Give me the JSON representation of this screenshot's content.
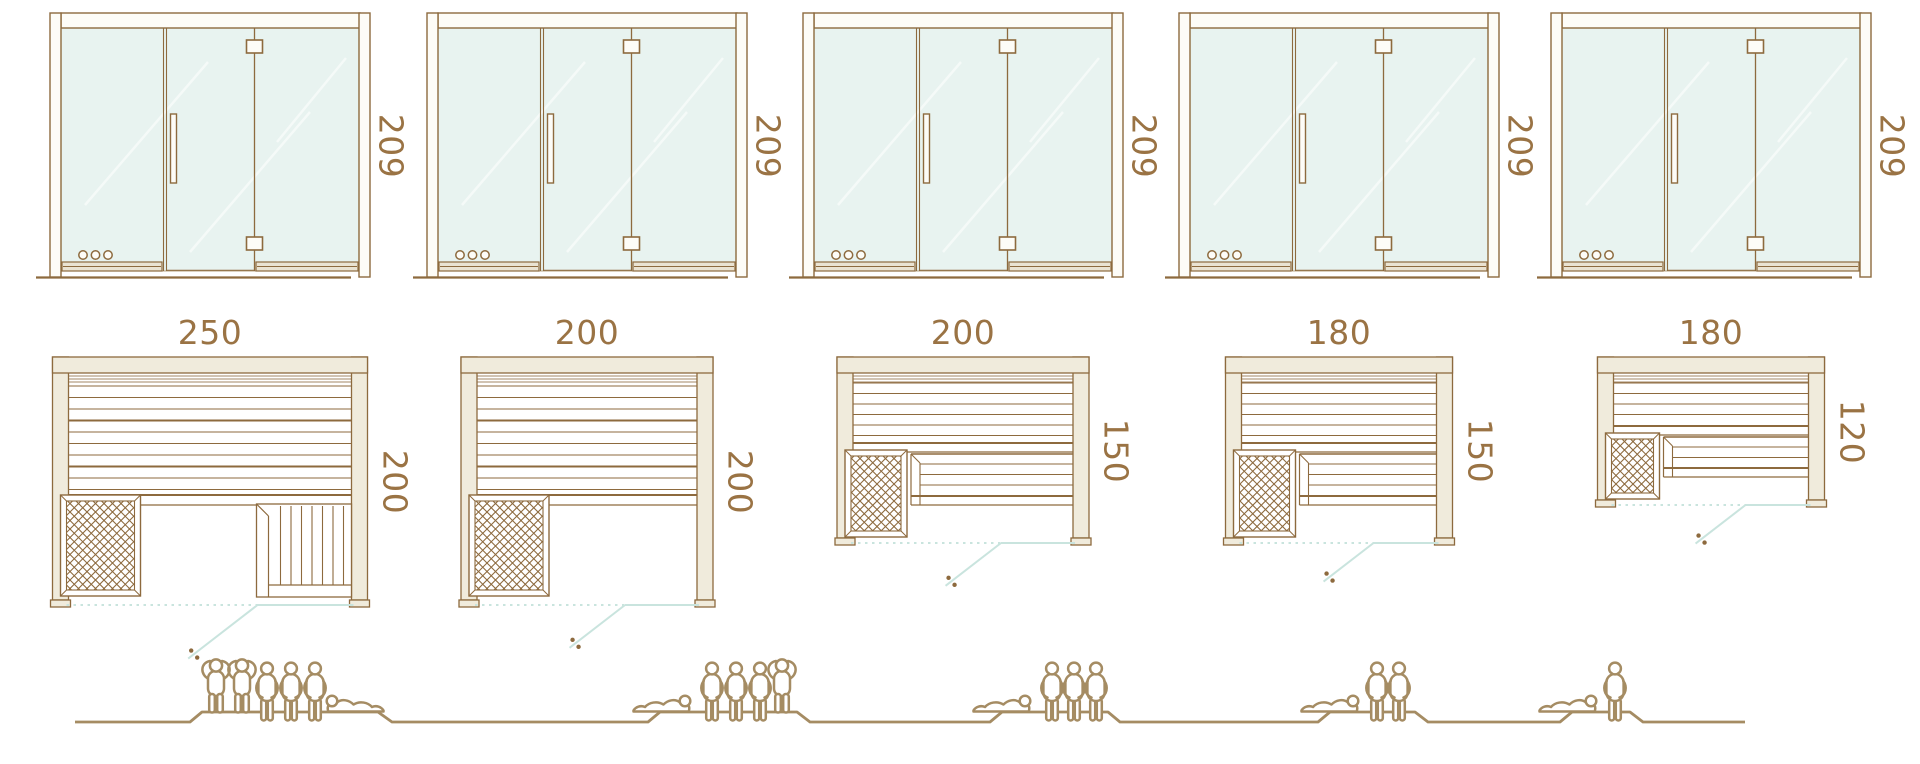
{
  "diagram": {
    "kind": "sauna size comparison",
    "views": [
      "front-elevation",
      "floor-plan",
      "capacity-figures"
    ]
  },
  "colors": {
    "outline": "#8d6a3e",
    "wall_fill": "#f0ebdc",
    "frame_fill": "#fdfcf7",
    "sill_fill": "#eae3d2",
    "glass_fill": "#e8f3f0",
    "glass_line": "#c9e4de",
    "label_text": "#9a7344",
    "people": "#a58c63"
  },
  "units": [
    {
      "id": "unit-1",
      "elevation": {
        "height_label": "209"
      },
      "plan": {
        "width_label": "250",
        "depth_label": "200",
        "width_cm": 250,
        "depth_cm": 200,
        "heater": true,
        "entry_step": true,
        "split_bench": false
      },
      "capacity": {
        "persons": 6,
        "figures": [
          "standing",
          "standing",
          "seated",
          "seated",
          "seated",
          "reclining"
        ]
      }
    },
    {
      "id": "unit-2",
      "elevation": {
        "height_label": "209"
      },
      "plan": {
        "width_label": "200",
        "depth_label": "200",
        "width_cm": 200,
        "depth_cm": 200,
        "heater": true,
        "entry_step": false,
        "split_bench": false
      },
      "capacity": {
        "persons": 5,
        "figures": [
          "reclining",
          "seated",
          "seated",
          "seated",
          "standing"
        ]
      }
    },
    {
      "id": "unit-3",
      "elevation": {
        "height_label": "209"
      },
      "plan": {
        "width_label": "200",
        "depth_label": "150",
        "width_cm": 200,
        "depth_cm": 150,
        "heater": true,
        "entry_step": false,
        "split_bench": true
      },
      "capacity": {
        "persons": 4,
        "figures": [
          "reclining",
          "seated",
          "seated",
          "seated"
        ]
      }
    },
    {
      "id": "unit-4",
      "elevation": {
        "height_label": "209"
      },
      "plan": {
        "width_label": "180",
        "depth_label": "150",
        "width_cm": 180,
        "depth_cm": 150,
        "heater": true,
        "entry_step": false,
        "split_bench": true
      },
      "capacity": {
        "persons": 3,
        "figures": [
          "reclining",
          "seated",
          "seated"
        ]
      }
    },
    {
      "id": "unit-5",
      "elevation": {
        "height_label": "209"
      },
      "plan": {
        "width_label": "180",
        "depth_label": "120",
        "width_cm": 180,
        "depth_cm": 120,
        "heater": true,
        "entry_step": false,
        "split_bench": true
      },
      "capacity": {
        "persons": 2,
        "figures": [
          "reclining",
          "seated"
        ]
      }
    }
  ]
}
